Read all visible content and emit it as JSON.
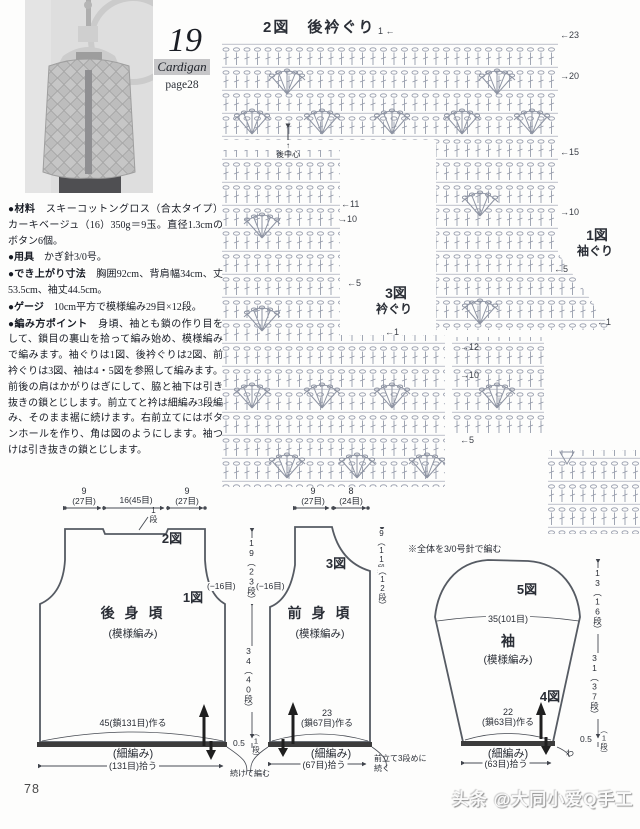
{
  "header": {
    "number": "19",
    "type_label": "Cardigan",
    "page_ref": "page28"
  },
  "instructions": [
    {
      "label": "●材料",
      "text": "　スキーコットングロス（合太タイプ）カーキベージュ（16）350g＝9玉。直径1.3cmのボタン6個。"
    },
    {
      "label": "●用具",
      "text": "　かぎ針3/0号。"
    },
    {
      "label": "●でき上がり寸法",
      "text": "　胸囲92cm、背肩幅34cm、丈53.5cm、袖丈44.5cm。"
    },
    {
      "label": "●ゲージ",
      "text": "　10cm平方で模様編み29目×12段。"
    },
    {
      "label": "●編み方ポイント",
      "text": "　身頃、袖とも鎖の作り目をして、鎖目の裏山を拾って編み始め、模様編みで編みます。袖ぐりは1図、後衿ぐりは2図、前衿ぐりは3図、袖は4・5図を参照して編みます。前後の肩はかがりはぎにして、脇と袖下は引き抜きの鎖とじします。前立てと衿は細編み3段編み、そのまま裾に続けます。右前立てにはボタンホールを作り、角は図のようにします。袖つけは引き抜きの鎖とじします。"
    }
  ],
  "charts": {
    "c2_title": "2図　後衿ぐり",
    "c2_start": "1 ←",
    "c2_center_arrow": "↑",
    "c2_center": "後中心",
    "c1_name": "1図",
    "c1_sub": "袖ぐり",
    "c3_name": "3図",
    "c3_sub": "衿ぐり",
    "note": "※全体を3/0号針で編む",
    "m": {
      "r23": "←23",
      "r20": "→20",
      "r15": "←15",
      "r10": "→10",
      "r5": "←5",
      "r1": "←1",
      "l11": "←11",
      "l10": "→10",
      "l5": "←5",
      "l1": "←1",
      "k12": "→12",
      "k10": "→10",
      "k5": "←5"
    }
  },
  "back": {
    "top_left_a": "9",
    "top_left_b": "(27目)",
    "top_center": "16(45目)",
    "top_right_a": "9",
    "top_right_b": "(27目)",
    "one_row": "1段",
    "fig2": "2図",
    "fig1": "1図",
    "minus": "(−16目)",
    "name": "後 身 頃",
    "stitch": "(模様編み)",
    "dim_upper": "19（23段）",
    "dim_lower": "34（40段）",
    "dim_half": "0.5",
    "dim_half2": "（1段）",
    "cont": "続けて編む",
    "cast": "45(鎖131目)作る",
    "band": "(細編み)",
    "pickup": "(131目)拾う"
  },
  "front": {
    "top_left_a": "9",
    "top_left_b": "(27目)",
    "top_right_a": "8",
    "top_right_b": "(24目)",
    "fig3": "3図",
    "minus": "(−16目)",
    "name": "前 身 頃",
    "stitch": "(模様編み)",
    "dim_a": "9（11段）",
    "dim_b": "（12段）",
    "cast_a": "23",
    "cast_b": "(鎖67目)作る",
    "band": "(細編み)",
    "pickup": "(67目)拾う",
    "next": "前立て3段めに続く"
  },
  "sleeve": {
    "fig5": "5図",
    "fig4": "4図",
    "width": "35(101目)",
    "name": "袖",
    "stitch": "(模様編み)",
    "dim_upper": "13（16段）",
    "dim_lower": "31（37段）",
    "dim_half": "0.5",
    "dim_half2": "（1段）",
    "cast_a": "22",
    "cast_b": "(鎖63目)作る",
    "band": "(細編み)",
    "pickup": "(63目)拾う",
    "wa": "わ"
  },
  "footer": {
    "page_number": "78",
    "watermark": "头条 @大同小爱Q手工"
  }
}
